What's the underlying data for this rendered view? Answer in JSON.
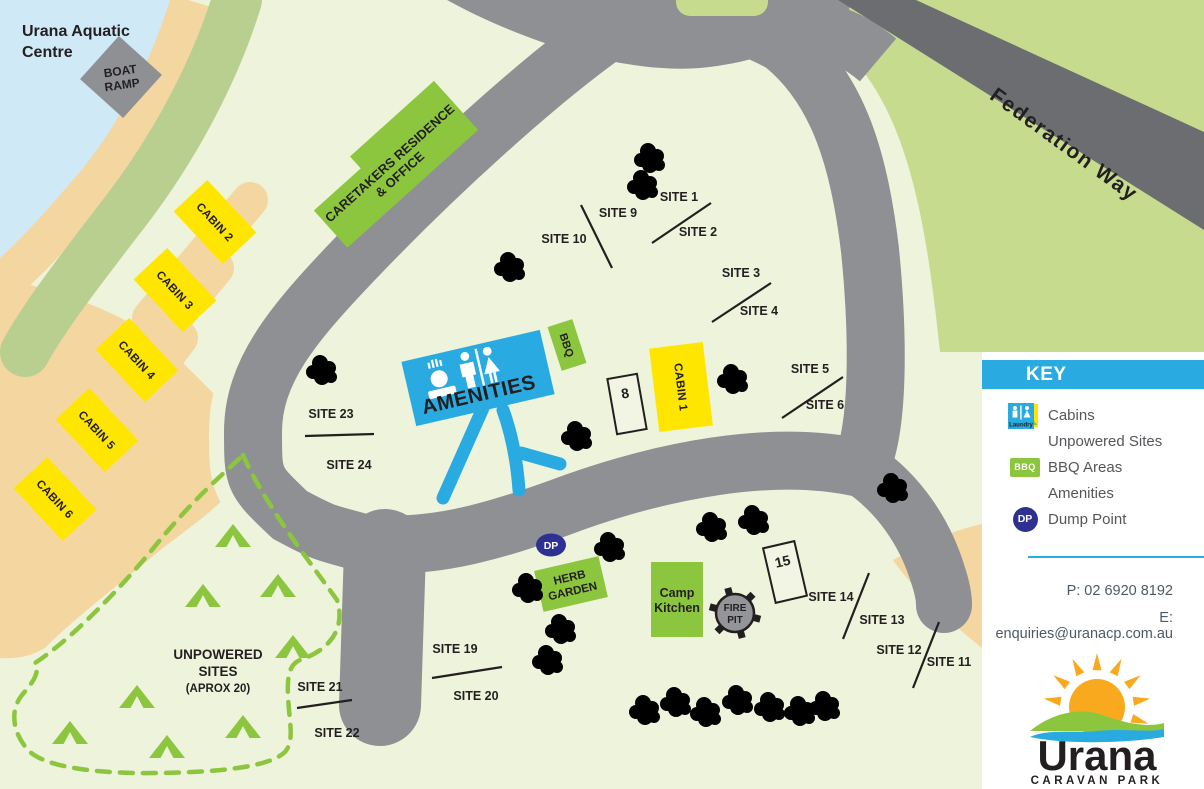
{
  "map": {
    "aquatic_centre": {
      "line1": "Urana Aquatic",
      "line2": "Centre"
    },
    "boat_ramp": {
      "line1": "BOAT",
      "line2": "RAMP"
    },
    "federation_way": "Federation Way",
    "caretakers": {
      "line1": "CARETAKERS RESIDENCE",
      "line2": "& OFFICE"
    },
    "amenities_label": "AMENITIES",
    "bbq_label": "BBQ",
    "herb_garden": {
      "line1": "HERB",
      "line2": "GARDEN"
    },
    "camp_kitchen": {
      "line1": "Camp",
      "line2": "Kitchen"
    },
    "fire_pit": {
      "line1": "FIRE",
      "line2": "PIT"
    },
    "dump_point_label": "DP",
    "unpowered": {
      "line1": "UNPOWERED",
      "line2": "SITES",
      "line3": "(APROX 20)"
    },
    "cabins": {
      "c1": "CABIN 1",
      "c2": "CABIN 2",
      "c3": "CABIN 3",
      "c4": "CABIN 4",
      "c5": "CABIN 5",
      "c6": "CABIN 6"
    },
    "sites": {
      "s1": "SITE 1",
      "s2": "SITE 2",
      "s3": "SITE 3",
      "s4": "SITE 4",
      "s5": "SITE 5",
      "s6": "SITE 6",
      "s9": "SITE 9",
      "s10": "SITE 10",
      "s11": "SITE 11",
      "s12": "SITE 12",
      "s13": "SITE 13",
      "s14": "SITE 14",
      "s19": "SITE 19",
      "s20": "SITE 20",
      "s21": "SITE 21",
      "s22": "SITE 22",
      "s23": "SITE 23",
      "s24": "SITE 24"
    },
    "numbered": {
      "n8": "8",
      "n15": "15"
    }
  },
  "key": {
    "title": "KEY",
    "items": [
      {
        "icon": "cabin-swatch",
        "label": "Cabins"
      },
      {
        "icon": "tent-icon",
        "label": "Unpowered Sites"
      },
      {
        "icon": "bbq-icon",
        "icon_text": "BBQ",
        "label": "BBQ Areas"
      },
      {
        "icon": "amenities-icon",
        "icon_text": "Laundry",
        "label": "Amenities"
      },
      {
        "icon": "dump-point-icon",
        "icon_text": "DP",
        "label": "Dump Point"
      }
    ]
  },
  "contact": {
    "phone": "P: 02 6920 8192",
    "email": "E: enquiries@uranacp.com.au"
  },
  "logo": {
    "name": "Urana",
    "subtitle": "CARAVAN PARK"
  },
  "colors": {
    "background": "#eef3dc",
    "water": "#cfe9f6",
    "sand": "#f4d6a0",
    "grass": "#c7db8e",
    "shore_green": "#b9cf90",
    "road": "#8e9093",
    "highway": "#6b6d70",
    "cabin_yellow": "#ffe600",
    "building_green": "#8cc63e",
    "amenities_blue": "#29abe2",
    "dump_point_blue": "#2e3192",
    "tree_green": "#2ab24b",
    "fire_pit_gray": "#939598"
  }
}
